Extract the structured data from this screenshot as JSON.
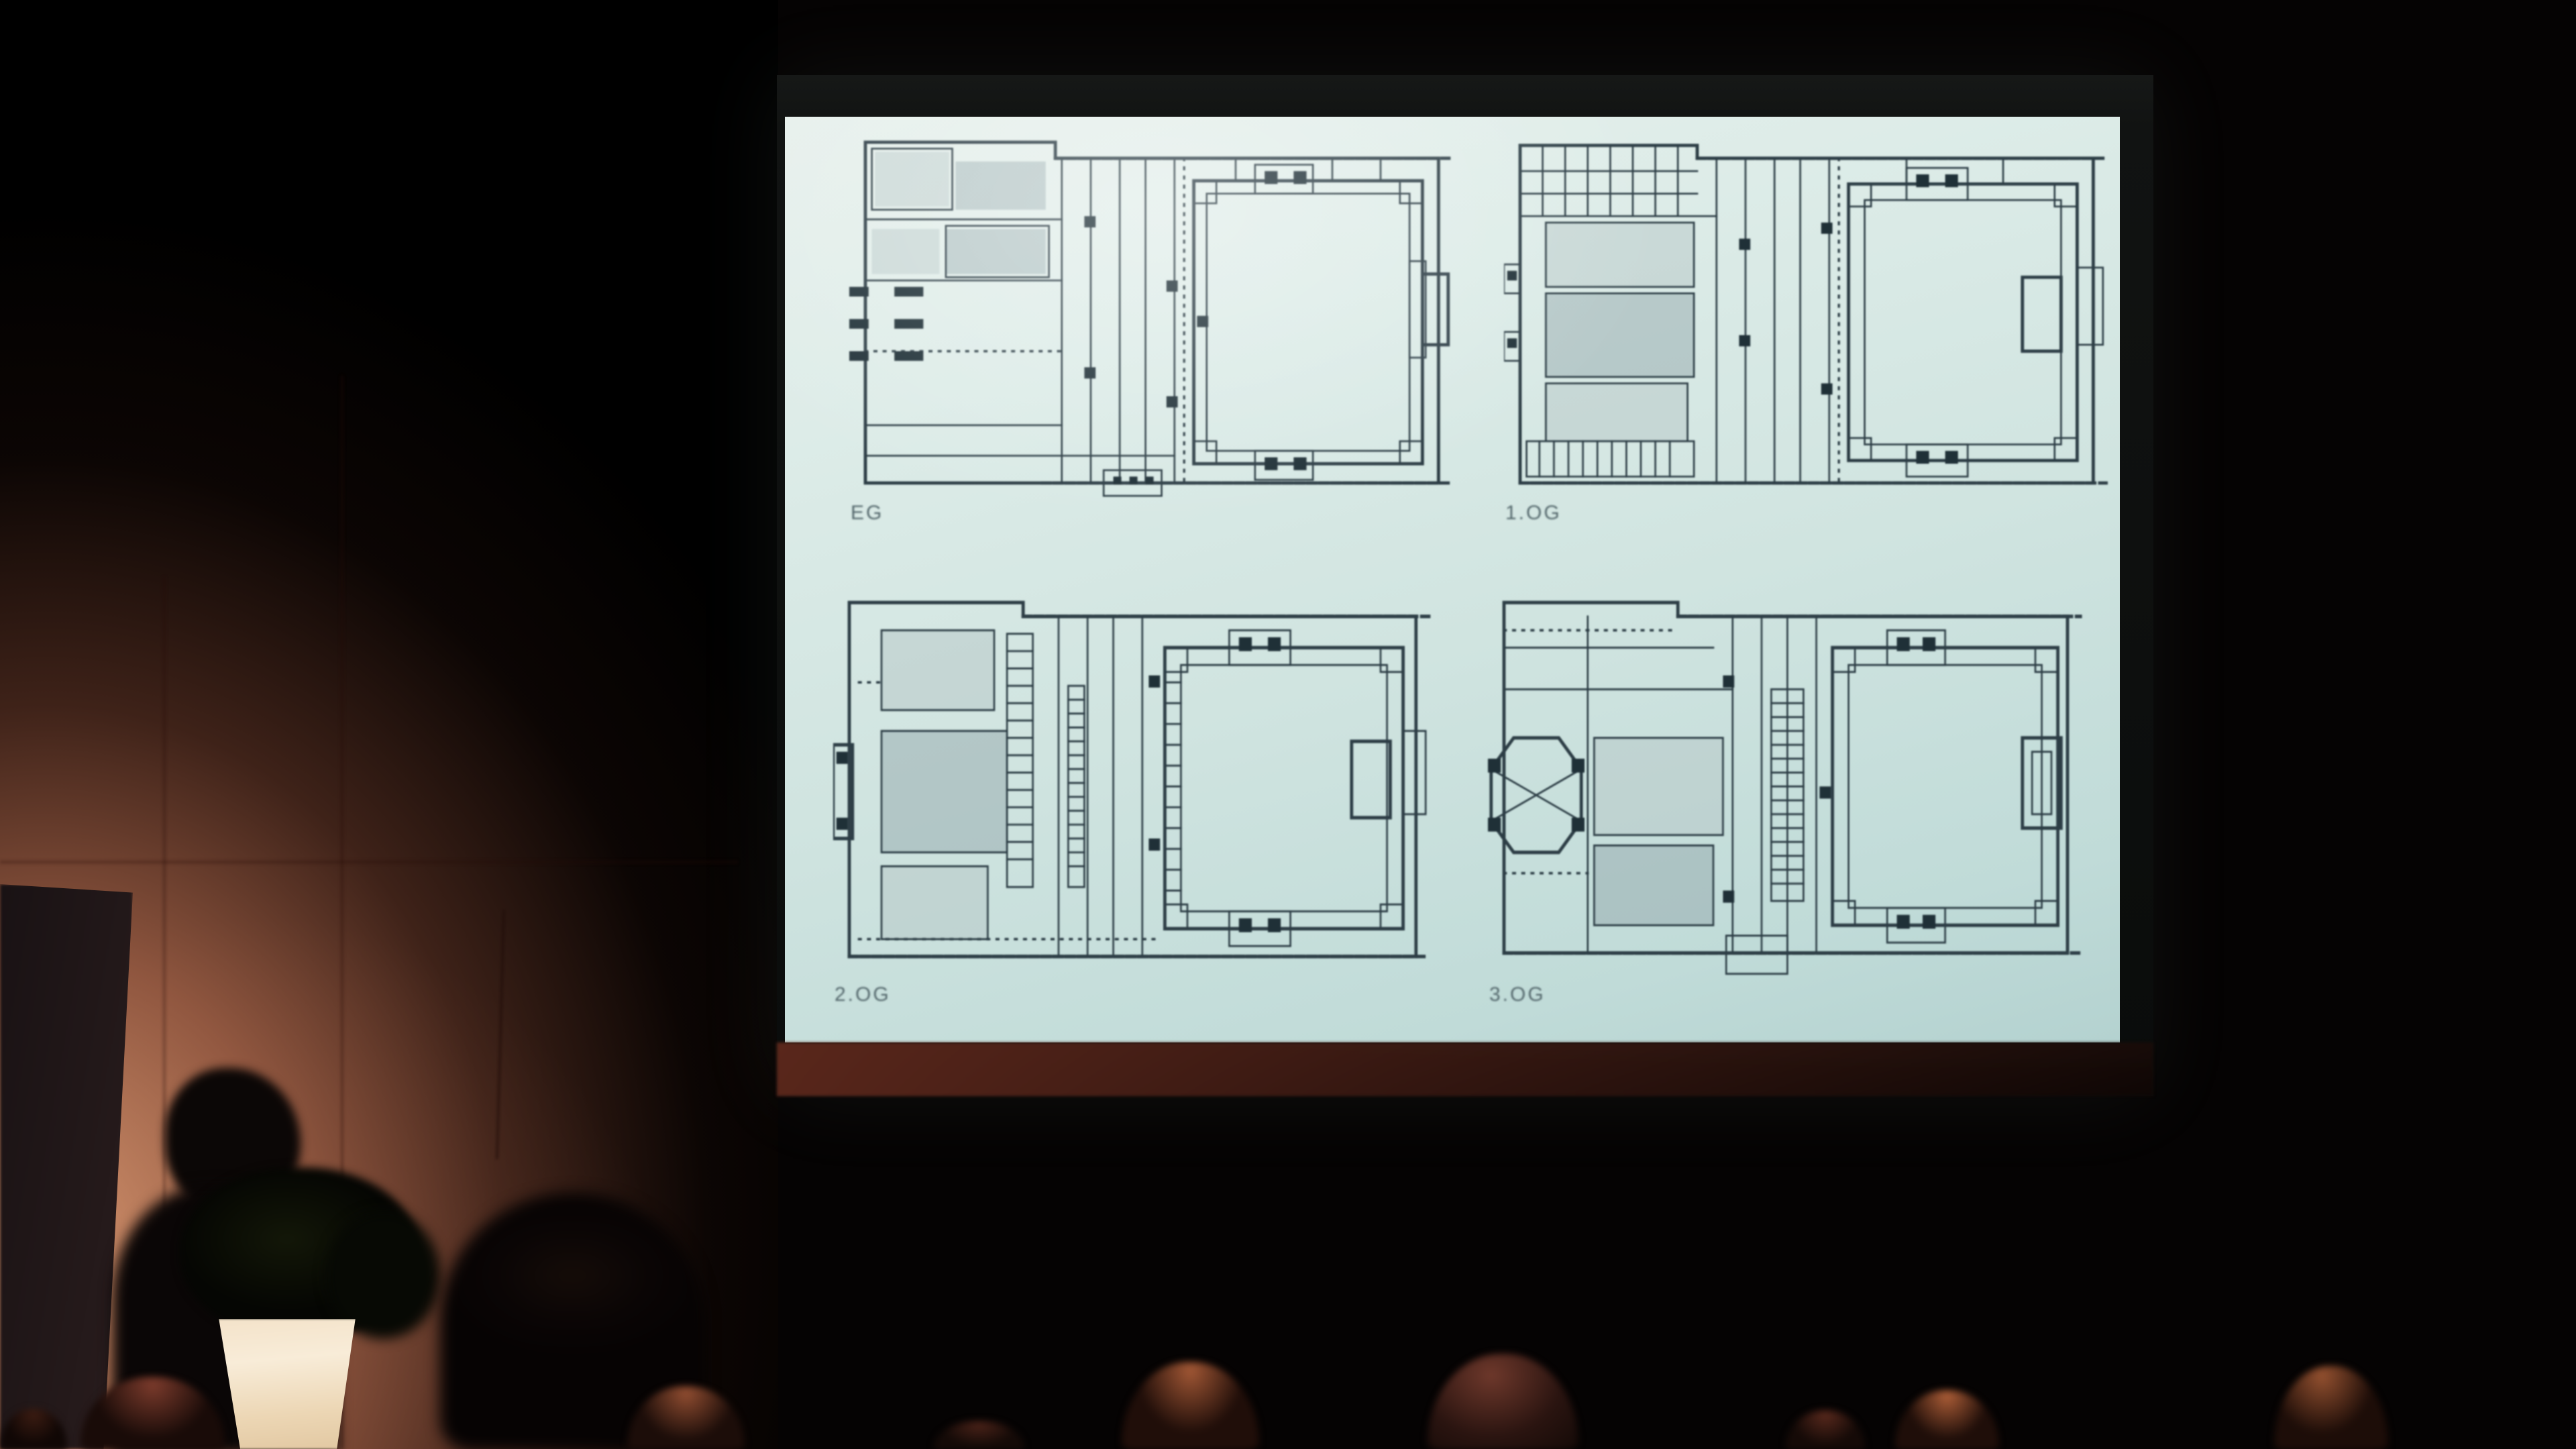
{
  "slide": {
    "type": "architectural-floor-plans",
    "background_color": "#d5e6e2",
    "linework_color": "#2b3d46",
    "plans": [
      {
        "label": "EG"
      },
      {
        "label": "1.OG"
      },
      {
        "label": "2.OG"
      },
      {
        "label": "3.OG"
      }
    ]
  },
  "scene": {
    "room_background_color": "#050303",
    "wall_color": "#b5826a",
    "screen_frame_color": "#121413",
    "below_screen_band_color": "#3f1e16",
    "planter_color": "#f2e2c8",
    "audience_head_rim_color": "#9c5433"
  }
}
